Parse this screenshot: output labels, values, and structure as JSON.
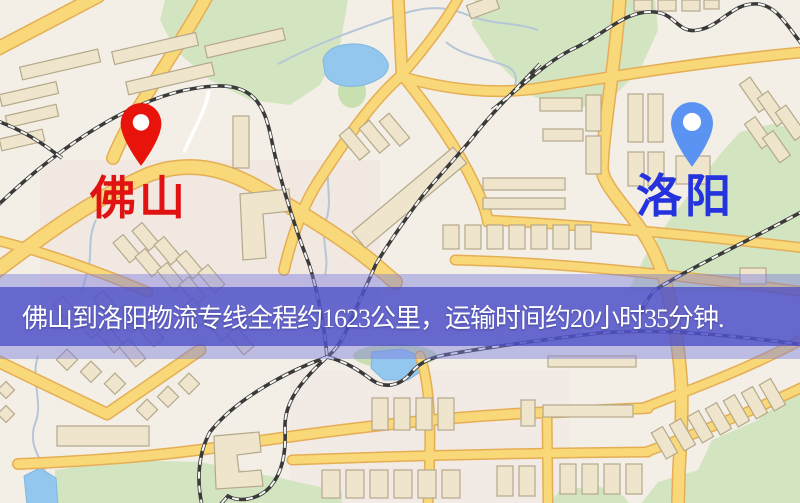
{
  "banner": {
    "text": "佛山到洛阳物流专线全程约1623公里，运输时间约20小时35分钟."
  },
  "markers": {
    "origin": {
      "label": "佛山"
    },
    "destination": {
      "label": "洛阳"
    }
  },
  "theme": {
    "origin-pin": "#e8130a",
    "origin-label": "#e01212",
    "dest-pin": "#5b93f2",
    "dest-label": "#2433dd",
    "banner-inner": "rgba(73,76,198,0.74)",
    "banner-outer": "rgba(122,124,222,0.45)",
    "banner-text": "#ffffff",
    "map-bg": "#f3efe6",
    "road-fill": "#f8d878",
    "road-edge": "#e5ae55",
    "water": "#93c7ee",
    "green": "#d3e5c0",
    "building": "#efe5cd",
    "building-edge": "#b5a98b",
    "rail-dark": "#3a3a3a",
    "rail-light": "#f7f7f4",
    "stream": "#b5c6d8",
    "white-road": "#ffffff"
  }
}
